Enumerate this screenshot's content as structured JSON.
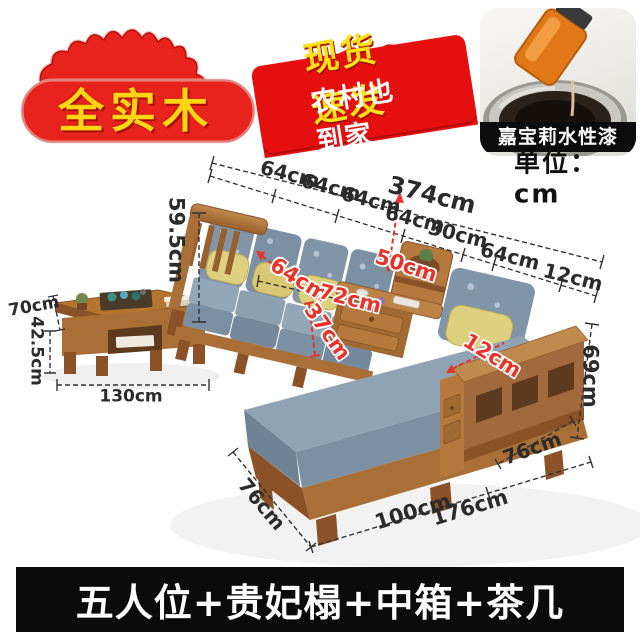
{
  "badges": {
    "solid_wood": {
      "text": "全实木"
    },
    "banner": {
      "line1": "现货速发",
      "line2": "农村也到家"
    },
    "paint": {
      "caption": "嘉宝莉水性漆"
    },
    "unit": {
      "label": "单位：cm"
    }
  },
  "dimensions": {
    "top": {
      "seg1": "64cm",
      "seg2": "64cm",
      "seg3": "64cm",
      "total": "374cm",
      "seg4": "64cm",
      "seg5": "30cm",
      "seg6": "64cm",
      "seg7": "12cm"
    },
    "left_height": "59.5cm",
    "right_height": "69cm",
    "chaise_left_depth": "76cm",
    "chaise_front": "100cm",
    "front_total": "176cm",
    "right_front": "76cm",
    "red": {
      "seat_depth": "64cm",
      "back_cushion_height": "50cm",
      "seat_width": "72cm",
      "seat_height": "37cm",
      "armrest_width": "12cm"
    },
    "table": {
      "depth": "70cm",
      "base_height": "42.5cm",
      "length": "130cm"
    }
  },
  "footer": {
    "title": "五人位+贵妃榻+中箱+茶几"
  },
  "colors": {
    "accent_red": "#e8231d",
    "accent_yellow": "#ffd514",
    "wood": "#a2693c",
    "fabric_blue": "#8095a8",
    "pillow_yellow": "#ddd07f",
    "label_red": "#e8332a",
    "footer_bg": "#0b0b0b"
  }
}
